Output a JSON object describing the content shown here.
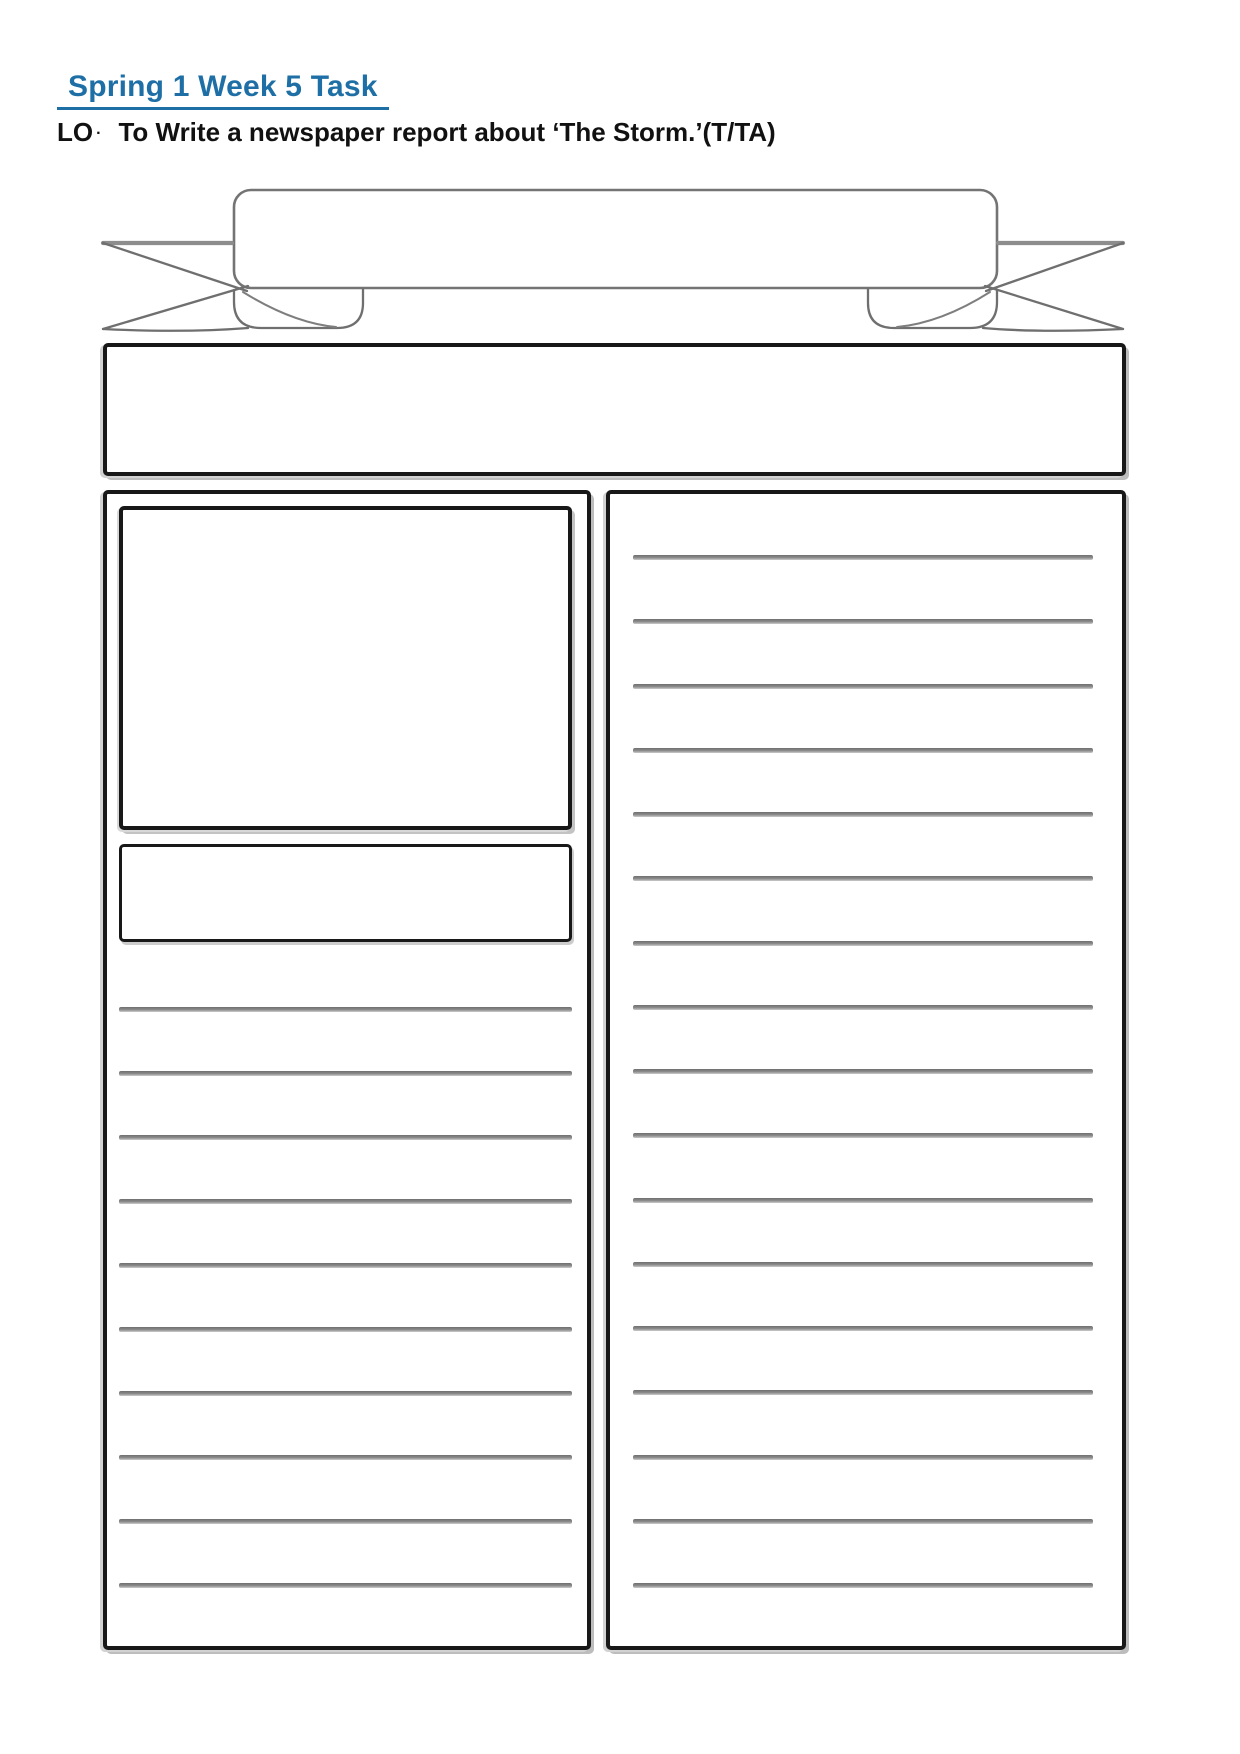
{
  "document": {
    "heading": {
      "text": "Spring 1 Week 5 Task"
    },
    "learning_objective": {
      "prefix": "LO",
      "bullet": "·",
      "text": "To Write a newspaper report about ‘The Storm.’(T/TA)"
    }
  },
  "template": {
    "masthead_banner": {
      "shape": "ribbon-banner",
      "content": ""
    },
    "headline_box": {
      "content": ""
    },
    "left_column": {
      "picture_box_content": "",
      "caption_box_content": "",
      "writing_lines_count": 10
    },
    "right_column": {
      "writing_lines_count": 17
    }
  },
  "colors": {
    "heading": "#1d6fa6",
    "box_border": "#181818",
    "rule_line": "#8d8d8d",
    "banner_stroke": "#747474"
  }
}
